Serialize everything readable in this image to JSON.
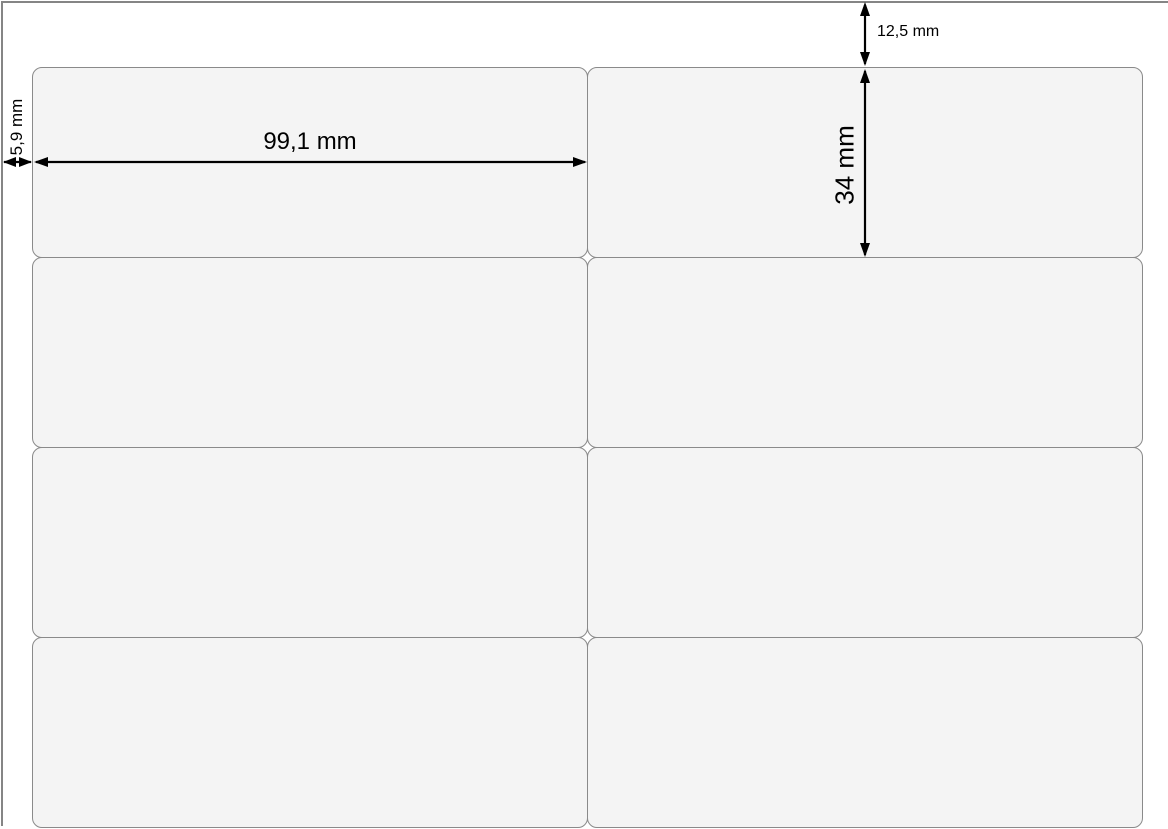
{
  "sheet": {
    "columns": 2,
    "visible_rows": 4,
    "colors": {
      "label_fill": "#f4f4f4",
      "label_border": "#8a8a8a",
      "page_border": "#858585",
      "dimension_color": "#000000"
    }
  },
  "dimensions": {
    "top_margin_label": "12,5 mm",
    "left_margin_label": "5,9 mm",
    "label_width_label": "99,1 mm",
    "label_height_label": "34 mm"
  }
}
